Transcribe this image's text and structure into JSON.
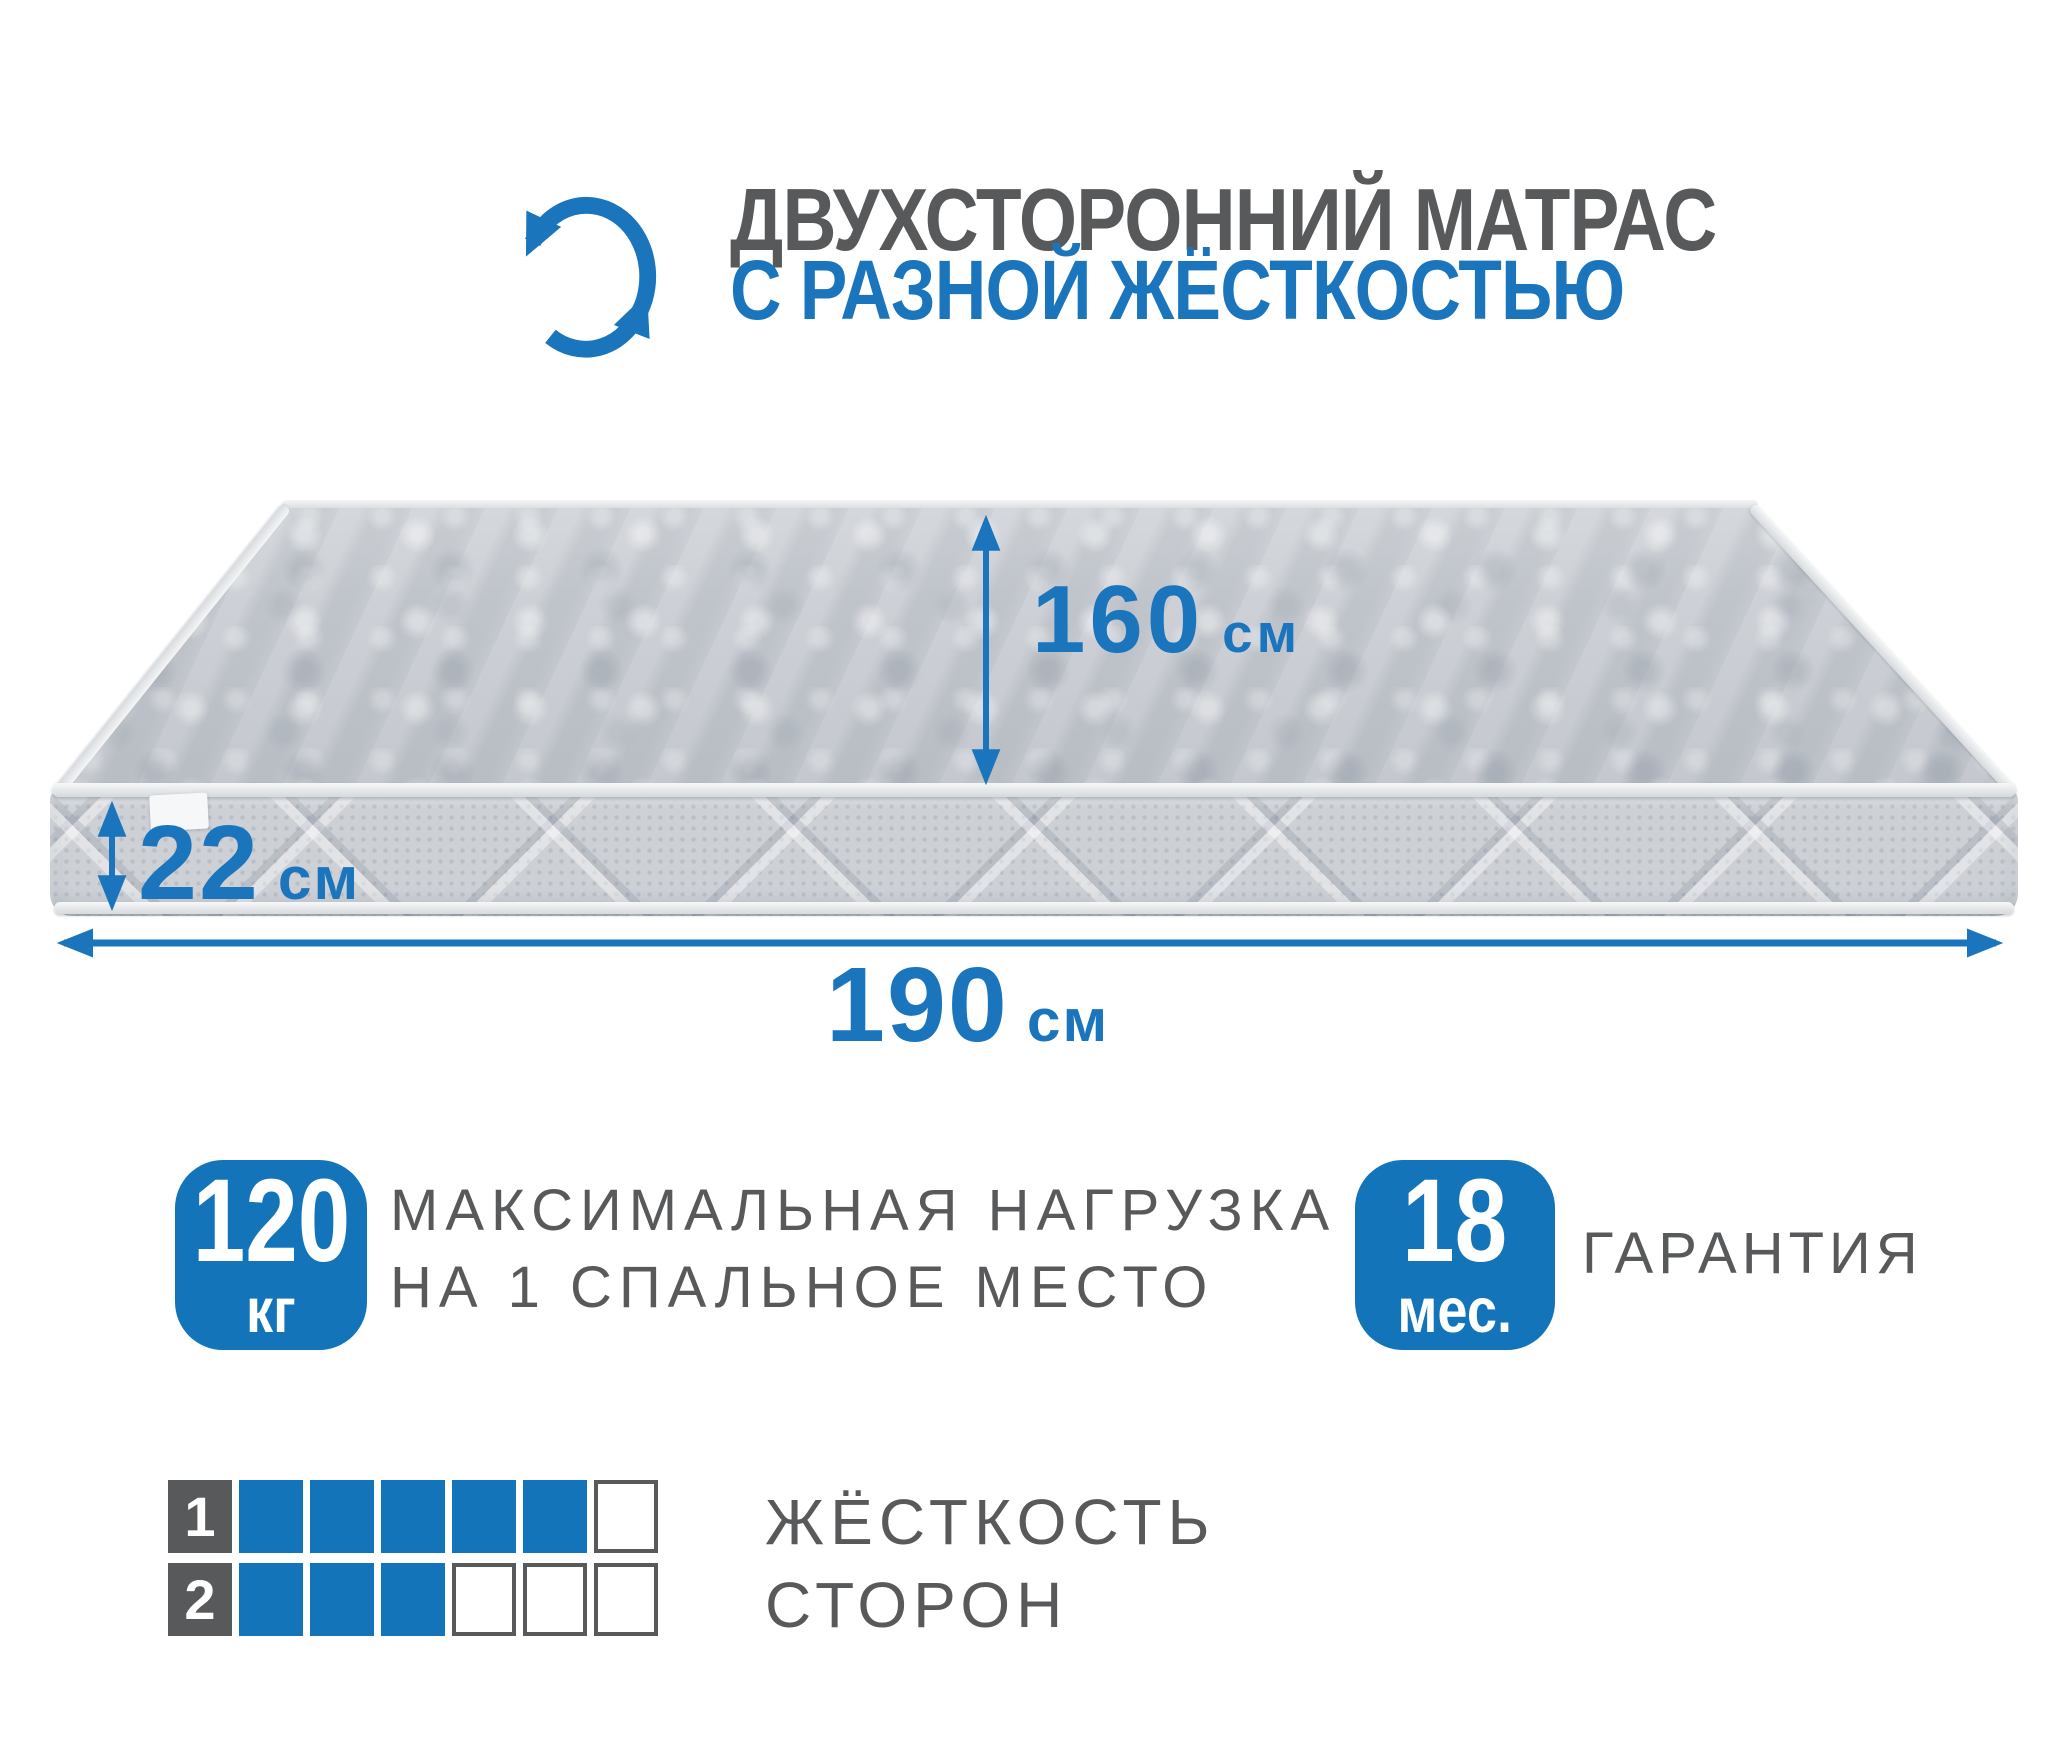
{
  "header": {
    "icon": "rotate-arrows-icon",
    "title_line1": "ДВУХСТОРОННИЙ МАТРАС",
    "title_line2": "С РАЗНОЙ ЖЁСТКОСТЬЮ"
  },
  "dimensions": {
    "width": {
      "value": "160",
      "unit": "см"
    },
    "height": {
      "value": "22",
      "unit": "см"
    },
    "length": {
      "value": "190",
      "unit": "см"
    }
  },
  "features": {
    "max_load": {
      "value": "120",
      "unit": "кг",
      "line1": "МАКСИМАЛЬНАЯ НАГРУЗКА",
      "line2": "НА 1 СПАЛЬНОЕ МЕСТО"
    },
    "warranty": {
      "value": "18",
      "unit": "мес.",
      "label": "ГАРАНТИЯ"
    }
  },
  "hardness": {
    "line1": "ЖЁСТКОСТЬ",
    "line2": "СТОРОН",
    "scale_max": 6,
    "rows": [
      {
        "side": "1",
        "filled": 5
      },
      {
        "side": "2",
        "filled": 3
      }
    ]
  },
  "colors": {
    "accent": "#1b75bc",
    "accent_deep": "#1374b9",
    "dark": "#58595b",
    "mattress_top": "#c6cad0",
    "mattress_band": "#cdd1d6",
    "piping": "#eef0f2"
  }
}
